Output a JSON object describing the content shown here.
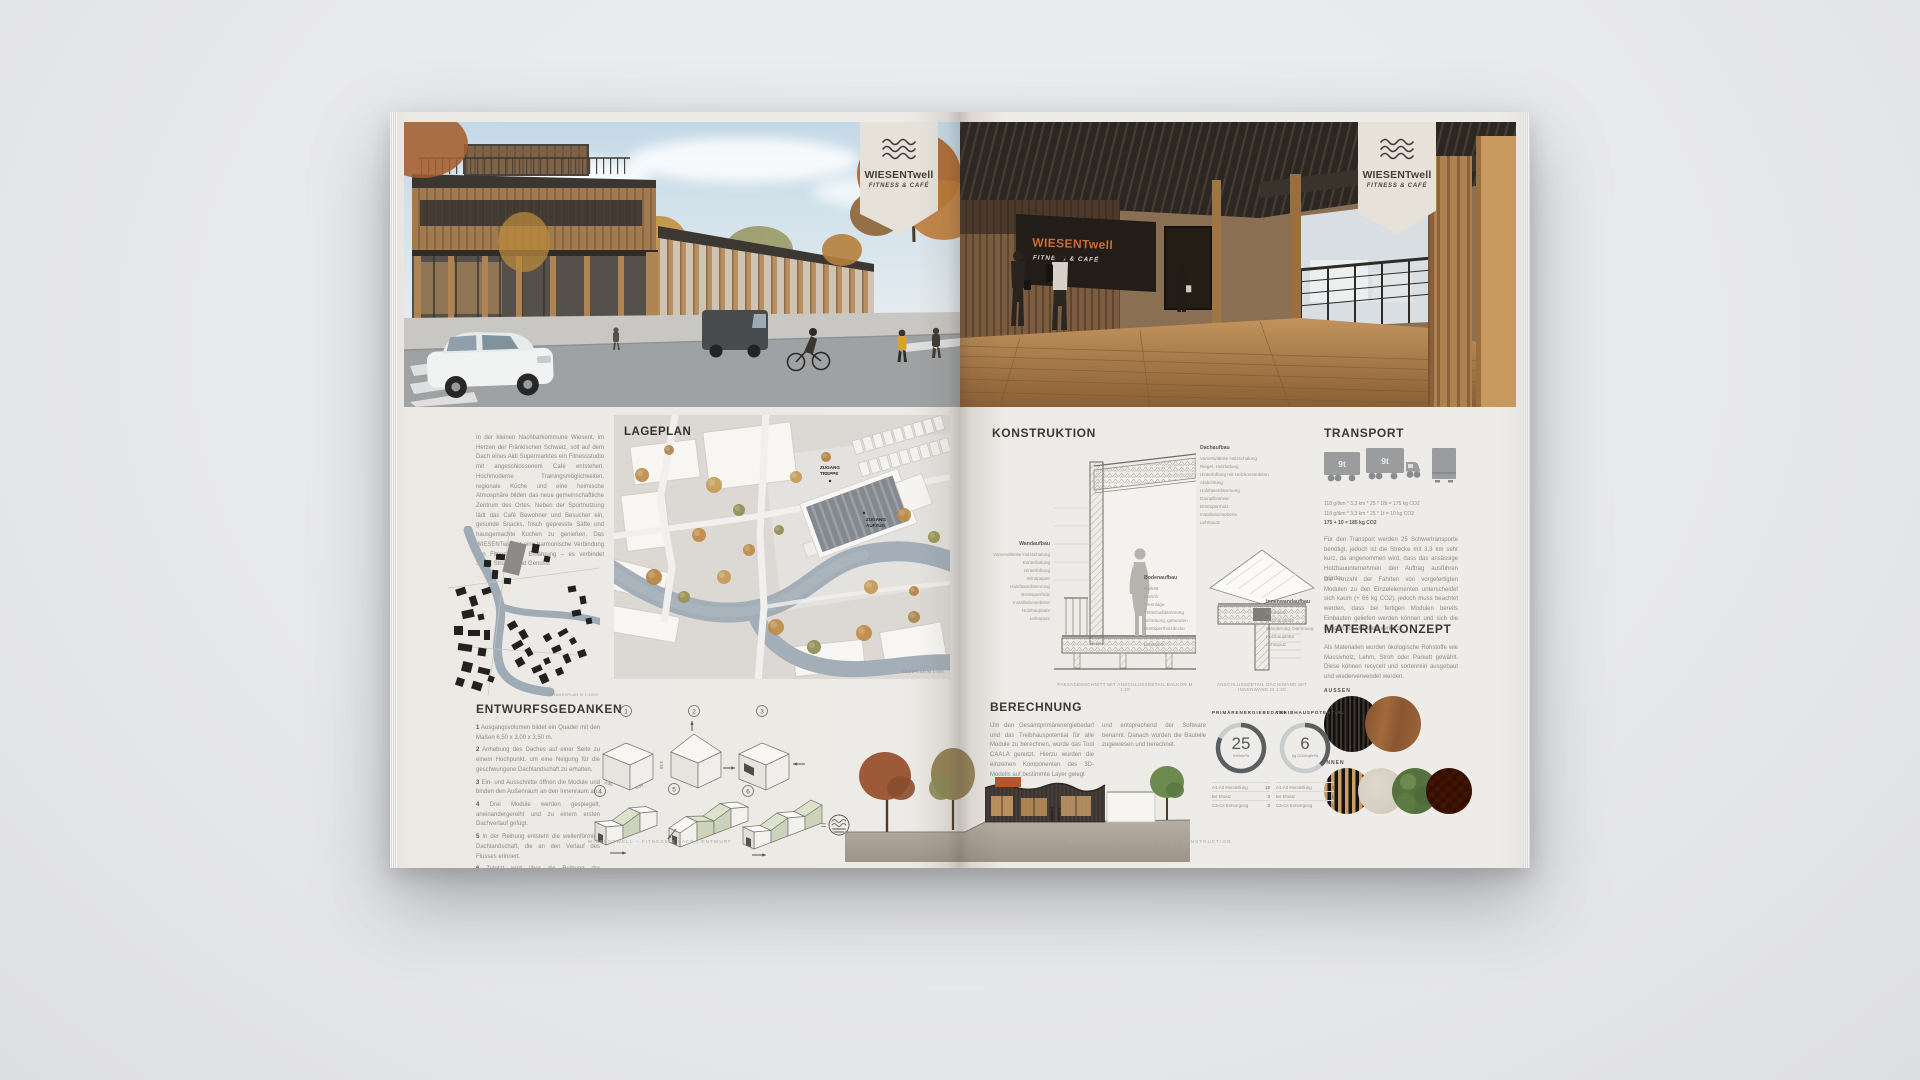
{
  "brand": {
    "name": "WIESENTwell",
    "tagline": "FITNESS & CAFÉ",
    "logo_icon": "wave-lines-icon"
  },
  "left_page": {
    "intro": "In der kleinen Nachbarkommune Wiesent, im Herzen der Fränkischen Schweiz, soll auf dem Dach eines Aldi Supermarktes ein Fitnessstudio mit angeschlossenem Café entstehen. Hochmoderne Trainingsmöglichkeiten, regionale Küche und eine heimische Atmosphäre bilden das neue gemeinschaftliche Zentrum des Ortes. Neben der Sportnutzung lädt das Café Bewohner und Besucher ein, gesunde Snacks, frisch gepresste Säfte und hausgemachte Kuchen zu genießen. Das WIESENTwell ist eine harmonische Verbindung von Fitness und Ernährung – es verbindet Sport, Struktur und Genuss.",
    "lageplan": {
      "title": "LAGEPLAN",
      "label_access_stairs_1": "ZUGANG",
      "label_access_stairs_2": "TREPPE",
      "label_access_lift_1": "ZUGANG",
      "label_access_lift_2": "AUFZUG",
      "caption": "LAGEPLAN M 1:500"
    },
    "schwarzplan": {
      "caption": "SCHWARZPLAN M 1:5000"
    },
    "entwurf": {
      "heading": "ENTWURFSGEDANKEN",
      "items": [
        {
          "n": "1",
          "t": "Ausgangsvolumen bildet ein Quader mit den Maßen 6,50 x 3,00 x 3,50 m."
        },
        {
          "n": "2",
          "t": "Anhebung des Daches auf einer Seite zu einem Hochpunkt, um eine Neigung für die geschwungene Dachlandschaft zu erhalten."
        },
        {
          "n": "3",
          "t": "Ein- und Ausschnitte öffnen die Module und binden den Außenraum an den Innenraum an."
        },
        {
          "n": "4",
          "t": "Drei Module werden gespiegelt, aneinandergereiht und zu einem ersten Dachverlauf gefügt."
        },
        {
          "n": "5",
          "t": "In der Reihung entsteht die wellenförmige Dachlandschaft, die an den Verlauf des Flusses erinnert."
        },
        {
          "n": "6",
          "t": "Zuletzt wird über die Reihung der Außenraum räumlich eingefasst – dadurch wird die Wesensform des Ortes aufgenommen."
        }
      ],
      "closing": "Insgesamt entsteht damit die Wiedererkennbarkeit des WIESENTwell und greift mit seiner wellenförmigen Dachlandschaft die Form und den Verlauf der Wiesent auf.",
      "numbers": [
        "1",
        "2",
        "3",
        "4",
        "5",
        "6"
      ],
      "dims": {
        "depth": "3,00",
        "length": "6,50",
        "height": "3,50"
      },
      "equals": "=",
      "result_icon": "wave-circle-icon"
    },
    "footer": "WIESENTWELL – FITNESS & CAFÉ | ENTWURF"
  },
  "right_page": {
    "render_sign": {
      "name": "WIESENTwell",
      "tagline": "FITNESS & CAFÉ"
    },
    "konstruktion": {
      "heading": "KONSTRUKTION",
      "dach_label": "Dachaufbau",
      "dach_layers": [
        "Vorverwitterte Holzschalung",
        "Riegel, Holzlattung",
        "Hinterlüftung mit Holzkonstruktion",
        "Abdichtung",
        "Holzfaserdämmung",
        "Dampfbremse",
        "Brettsperrholz",
        "Installationsebene",
        "Lehmputz"
      ],
      "wand_label": "Wandaufbau",
      "wand_layers": [
        "Vorverwitterte Holzschalung",
        "Konterlattung",
        "Hinterlüftung",
        "Windpapier",
        "Holzfaserdämmung",
        "Brettsperrholz",
        "Installationsebene",
        "Holzbauplatte",
        "Lehmputz"
      ],
      "boden_label": "Bodenaufbau",
      "boden_layers": [
        "Parkett",
        "Estrich",
        "Trennlage",
        "Trittschalldämmung",
        "Schüttung, gebunden",
        "Brettsperrholzdecke",
        "Abhangdecke",
        "Lehmputz"
      ],
      "innenwand_label": "Innenwandaufbau",
      "innenwand_layers": [
        "Lehmputz",
        "Holzbauplatte",
        "Ständerung, Dämmung",
        "Holzbauplatte",
        "Lehmputz"
      ],
      "caption_schnitt": "FASSADENSCHNITT MIT ANSCHLUSSDETAIL BALKON M 1:20",
      "caption_detail": "ANSCHLUSSDETAIL DACH/WAND MIT INNENWAND M 1:20"
    },
    "transport": {
      "heading": "TRANSPORT",
      "truck_load_1": "9t",
      "truck_load_2": "9t",
      "formula_1": "118 g/tkm * 3,3 km * 25 * 18t = 175 kg CO2",
      "formula_2": "118 g/tkm * 3,3 km * 25 * 1t = 10 kg CO2",
      "formula_total": "175 + 10 = 185 kg CO2",
      "p1": "Für den Transport werden 25 Schwertransporte benötigt, jedoch ist die Strecke mit 3,3 km sehr kurz, da angenommen wird, dass das ansässige Holzbauunternehmen den Auftrag ausführen würde.",
      "p2": "Die Anzahl der Fahrten von vorgefertigten Modulen zu den Einzelelementen unterscheidet sich kaum (+ 66 kg CO2), jedoch muss beachtet werden, dass bei fertigen Modulen bereits Einbauten geliefert werden können und sich die Bauzeit vor Ort stark verkürzt."
    },
    "materialkonzept": {
      "heading": "MATERIALKONZEPT",
      "text": "Als Materialien wurden ökologische Rohstoffe wie Massivholz, Lehm, Stroh oder Parkett gewählt. Diese können recycelt und sortenrein ausgebaut und wiederverwendet werden.",
      "aussen_label": "AUSSEN",
      "innen_label": "INNEN",
      "aussen_swatches": [
        "Holzlattung dunkel",
        "Holzfassade"
      ],
      "innen_swatches": [
        "Holzlamellen",
        "Lehmputz",
        "Mooswand",
        "Parkett Fischgrät"
      ]
    },
    "berechnung": {
      "heading": "BERECHNUNG",
      "p1": "Um den Gesamtprimärenergiebedarf und das Treibhauspotential für alle Module zu berechnen, wurde das Tool CAALA genutzt. Hierzu wurden die einzelnen Komponenten des 3D-Modells auf bestimmte Layer gelegt",
      "p2": "und entsprechend der Software benannt. Danach wurden die Bauteile zugewiesen und berechnet.",
      "gauges": [
        {
          "title": "PRIMÄRENERGIEBEDARF",
          "value": "25",
          "unit": "kWh/m²a",
          "ring_fraction": 0.82,
          "legend": [
            {
              "label": "A1-A3 Herstellung",
              "value": "19"
            },
            {
              "label": "B4 Ersatz",
              "value": "3"
            },
            {
              "label": "C3-C4 Entsorgung",
              "value": "3"
            }
          ]
        },
        {
          "title": "TREIBHAUSPOTENTIAL",
          "value": "6",
          "unit": "kg CO2eq/m²a",
          "ring_fraction": 0.38,
          "legend": [
            {
              "label": "A1-A3 Herstellung",
              "value": "4"
            },
            {
              "label": "B4 Ersatz",
              "value": "1"
            },
            {
              "label": "C3-C4 Entsorgung",
              "value": "1"
            }
          ]
        }
      ]
    },
    "footer": "WIESENTWELL – FITNESS & CAFÉ | KONSTRUKTION"
  },
  "colors": {
    "accent_orange": "#c06a32",
    "page": "#ebe9e5",
    "water": "#a2aeb8",
    "module_green": "#ccd3bb",
    "schwarzplan_black": "#232120",
    "gauge_dark": "#5b5e60",
    "wood": "#b18350"
  }
}
